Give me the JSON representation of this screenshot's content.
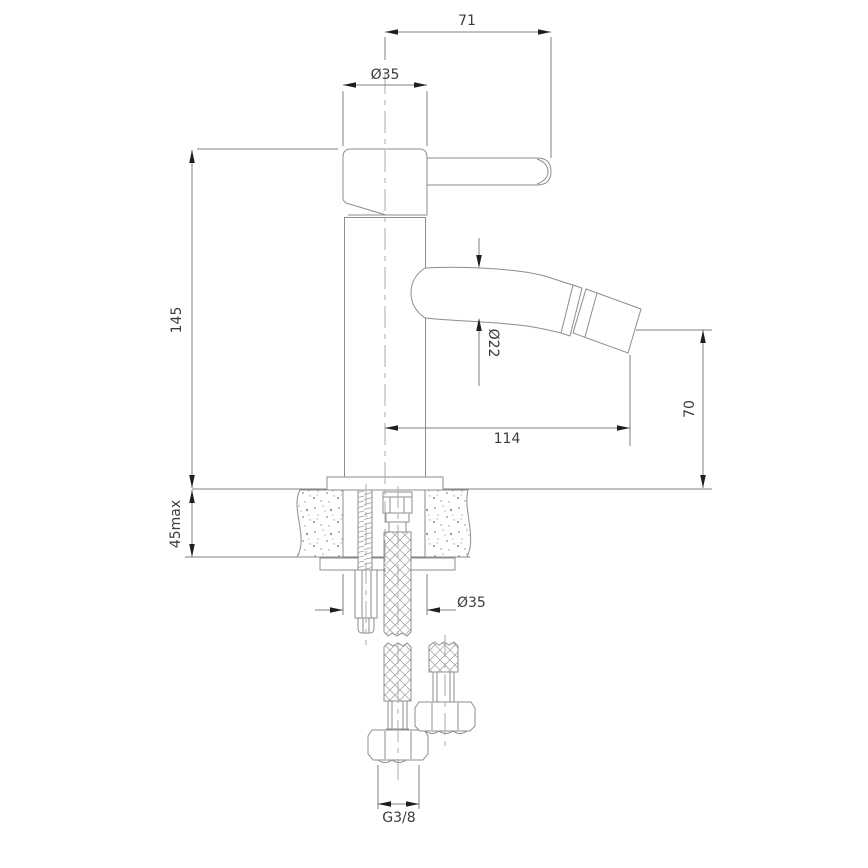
{
  "drawing": {
    "background": "#ffffff",
    "line_color": "#8e8e8e",
    "dimension_text_color": "#3c3c3c",
    "arrow_color": "#1f1f1f",
    "dimensions": {
      "lever_reach": "71",
      "top_diameter": "Ø35",
      "body_height": "145",
      "spout_diameter": "Ø22",
      "spout_reach": "114",
      "spout_height": "70",
      "mount_thickness": "45max",
      "base_diameter": "Ø35",
      "hose_thread": "G3/8"
    }
  }
}
